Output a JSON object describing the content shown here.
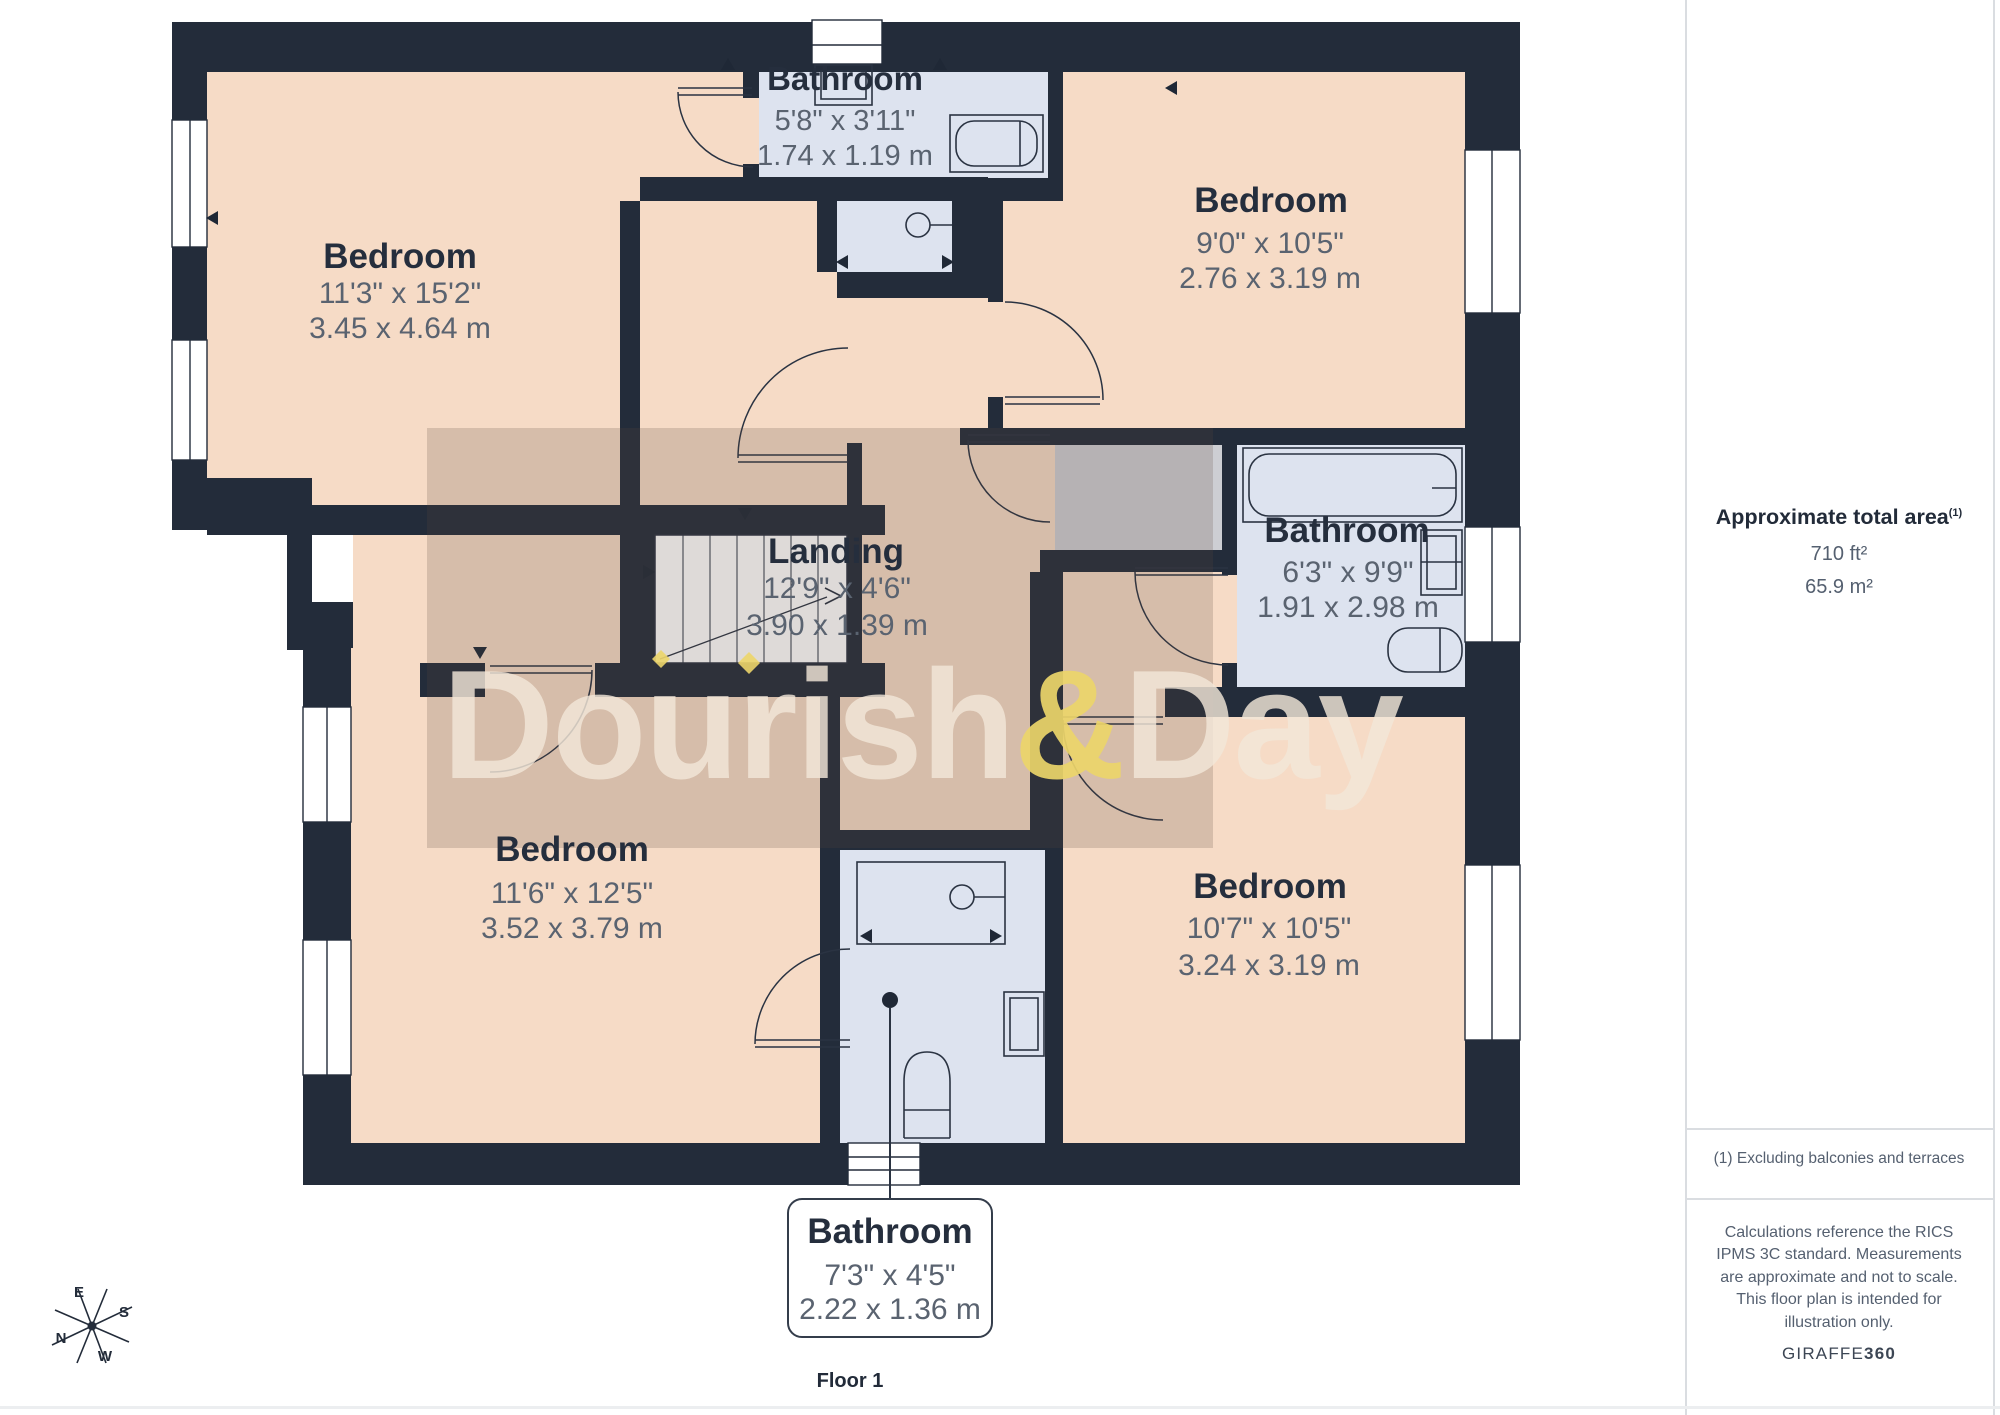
{
  "floorplan": {
    "floor_label": "Floor 1",
    "watermark": {
      "part1": "Dourish",
      "amp": "&",
      "part2": "Day"
    },
    "rooms": {
      "bedroom_tl": {
        "name": "Bedroom",
        "imperial": "11'3\" x 15'2\"",
        "metric": "3.45 x 4.64 m"
      },
      "bathroom_top": {
        "name": "Bathroom",
        "imperial": "5'8\" x 3'11\"",
        "metric": "1.74 x 1.19 m"
      },
      "bedroom_tr": {
        "name": "Bedroom",
        "imperial": "9'0\" x 10'5\"",
        "metric": "2.76 x 3.19 m"
      },
      "landing": {
        "name": "Landing",
        "imperial": "12'9\" x 4'6\"",
        "metric": "3.90 x 1.39 m"
      },
      "bathroom_mid": {
        "name": "Bathroom",
        "imperial": "6'3\" x 9'9\"",
        "metric": "1.91 x 2.98 m"
      },
      "bedroom_bl": {
        "name": "Bedroom",
        "imperial": "11'6\" x 12'5\"",
        "metric": "3.52 x 3.79 m"
      },
      "bedroom_br": {
        "name": "Bedroom",
        "imperial": "10'7\" x 10'5\"",
        "metric": "3.24 x 3.19 m"
      },
      "bathroom_bottom": {
        "name": "Bathroom",
        "imperial": "7'3\" x 4'5\"",
        "metric": "2.22 x 1.36 m"
      }
    },
    "compass": {
      "east": "E",
      "south": "S",
      "north": "N",
      "west": "W"
    }
  },
  "sidebar": {
    "area_heading": "Approximate total area",
    "area_heading_sup": "(1)",
    "area_ft": "710 ft²",
    "area_m": "65.9 m²",
    "footnote": "(1) Excluding balconies and terraces",
    "disclaimer": "Calculations reference the RICS IPMS 3C standard. Measurements are approximate and not to scale. This floor plan is intended for illustration only.",
    "brand_name": "GIRAFFE",
    "brand_number": "360"
  },
  "colors": {
    "wall": "#232c3a",
    "room_fill": "#f6dbc6",
    "bathroom_fill": "#dde3ef",
    "storage_fill": "#cdced3",
    "watermark_text": "#f2e7d8",
    "watermark_amp": "#ecd56a",
    "dims_text": "#5a6370",
    "title_text": "#252e3d"
  }
}
